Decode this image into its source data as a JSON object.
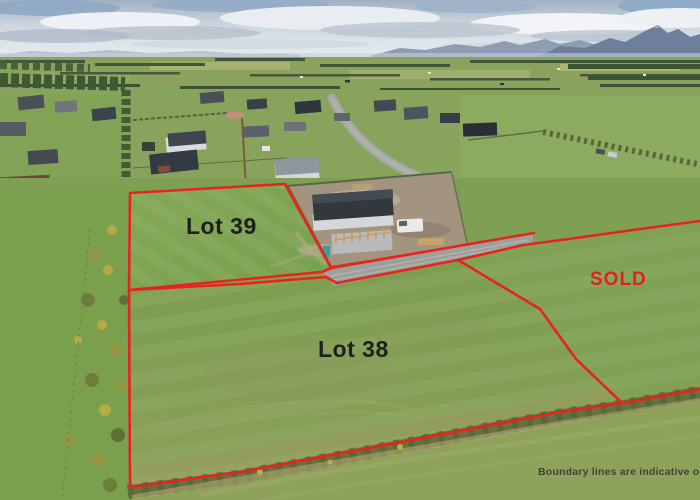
{
  "overlay": {
    "lot39_label": "Lot 39",
    "lot38_label": "Lot 38",
    "sold_label": "SOLD",
    "disclaimer": "Boundary lines are indicative only"
  },
  "colors": {
    "boundary_line": "#e8231d",
    "sold_text": "#e3201a",
    "lot_label_text": "#1f1f1f",
    "disclaimer_text": "#3c3c32"
  }
}
